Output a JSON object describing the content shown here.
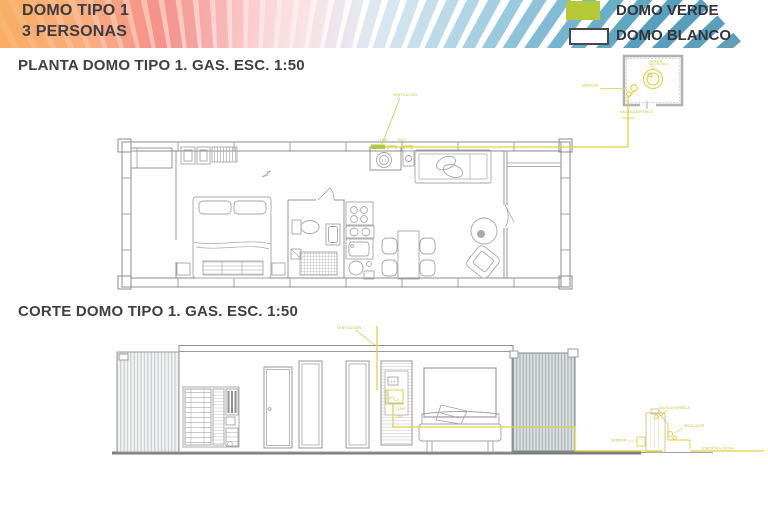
{
  "header": {
    "line1": "DOMO TIPO 1",
    "line2": "3 PERSONAS"
  },
  "legend": {
    "verde": {
      "label": "DOMO VERDE",
      "color": "#b5c938"
    },
    "blanco": {
      "label": "DOMO BLANCO",
      "color": "#ffffff"
    }
  },
  "plan": {
    "title": "PLANTA DOMO TIPO 1. GAS. ESC. 1:50",
    "labels": {
      "ventilacion": "VENTILACIÓN",
      "tag1": "LLAVE",
      "tag2": "GAS",
      "heater": "TT",
      "tank": "TANQUE",
      "medidor": "MEDIDOR",
      "valvula": "VÁLVULA ESFÉRICA"
    }
  },
  "corte": {
    "title": "CORTE DOMO TIPO 1. GAS. ESC. 1:50",
    "labels": {
      "ventilacion": "VENTILACIÓN",
      "heater": "TT",
      "tag1": "LLAVE",
      "tag2": "GAS",
      "valvula": "VÁLVULA ESFÉRICA",
      "regulador": "REGULADOR",
      "medidor": "MEDIDOR",
      "conexion": "CONEXIÓN A COCINA"
    }
  },
  "colors": {
    "gas_line": "#e3cf43",
    "gas_label": "#ccc040",
    "ventilation_label": "#c3c840",
    "accent_green": "#b5c938",
    "drawing_line": "#9e9e9e",
    "text": "#3c3c42"
  },
  "decor": {
    "fan_colors": [
      "#f6a96b",
      "#f7b076",
      "#f8b983",
      "#f9c28f",
      "#f9ca9b",
      "#f8c6a0",
      "#f7b39b",
      "#f5a198",
      "#f39598",
      "#f2909c",
      "#f298a4",
      "#f4a7b0",
      "#f6b8be",
      "#f8c9cd",
      "#fad7da",
      "#fbe2e4",
      "#fcebec",
      "#fbf0f1",
      "#f8f0f3",
      "#f3eef4",
      "#edecf4",
      "#e6eaf3",
      "#dfe8f2",
      "#d7e6f0",
      "#cfe3ee",
      "#c6dfec",
      "#bcdbe9",
      "#b1d6e6",
      "#a6d0e2",
      "#9acade",
      "#8ec3d9",
      "#82bcd4",
      "#76b5cf",
      "#6baec9",
      "#60a7c4",
      "#569fbe",
      "#569fbe",
      "#5a9fbc",
      "#5f9fba",
      "#649fb8"
    ]
  }
}
